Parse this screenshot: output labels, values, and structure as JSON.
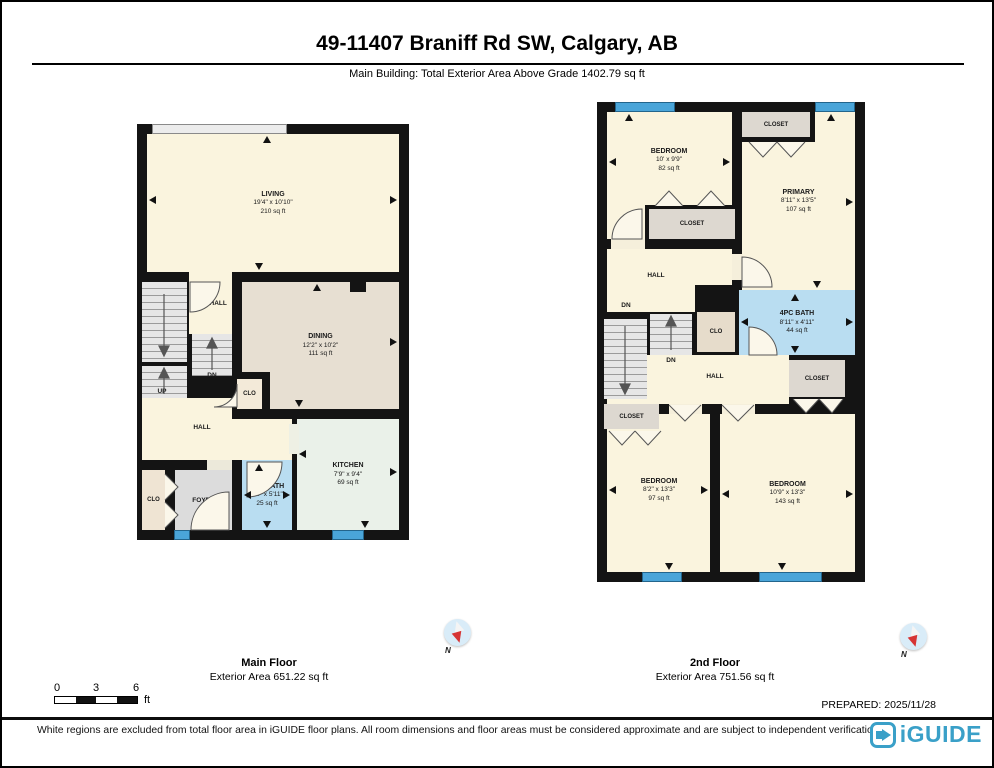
{
  "header": {
    "title": "49-11407 Braniff Rd SW, Calgary, AB",
    "subtitle": "Main Building: Total Exterior Area Above Grade 1402.79 sq ft"
  },
  "main_floor": {
    "label": "Main Floor",
    "area_label": "Exterior Area 651.22 sq ft",
    "rooms": {
      "living": {
        "name": "LIVING",
        "dims": "19'4\" x 10'10\"",
        "area": "210 sq ft"
      },
      "dining": {
        "name": "DINING",
        "dims": "12'2\" x 10'2\"",
        "area": "111 sq ft"
      },
      "kitchen": {
        "name": "KITCHEN",
        "dims": "7'9\" x 9'4\"",
        "area": "69 sq ft"
      },
      "bath": {
        "name": "2PC BATH",
        "dims": "4'4\" x 5'11\"",
        "area": "25 sq ft"
      },
      "foyer": "FOYER",
      "hall": "HALL",
      "clo": "CLO",
      "up": "UP",
      "dn": "DN"
    }
  },
  "second_floor": {
    "label": "2nd Floor",
    "area_label": "Exterior Area 751.56 sq ft",
    "rooms": {
      "bedroom_top": {
        "name": "BEDROOM",
        "dims": "10' x 9'9\"",
        "area": "82 sq ft"
      },
      "primary": {
        "name": "PRIMARY",
        "dims": "8'11\" x 13'5\"",
        "area": "107 sq ft"
      },
      "bath": {
        "name": "4PC BATH",
        "dims": "8'11\" x 4'11\"",
        "area": "44 sq ft"
      },
      "bedroom_left": {
        "name": "BEDROOM",
        "dims": "8'2\" x 13'3\"",
        "area": "97 sq ft"
      },
      "bedroom_right": {
        "name": "BEDROOM",
        "dims": "10'9\" x 13'3\"",
        "area": "143 sq ft"
      },
      "closet": "CLOSET",
      "clo": "CLO",
      "hall": "HALL",
      "dn": "DN"
    }
  },
  "compass": {
    "north_label": "N"
  },
  "scale_bar": {
    "t0": "0",
    "t3": "3",
    "t6": "6",
    "unit": "ft"
  },
  "prepared": "PREPARED: 2025/11/28",
  "footer": {
    "disclaimer": "White regions are excluded from total floor area in iGUIDE floor plans. All room dimensions and floor areas must be considered approximate and are subject to independent verification.",
    "logo_text": "iGUIDE"
  },
  "colors": {
    "wall_black": "#141414",
    "room_cream": "#faf4de",
    "dining_beige": "#e7dfd2",
    "kitchen_mint": "#eaf1e9",
    "bath_blue": "#b9ddf1",
    "closet_gray": "#ddd8d0",
    "clo_tan": "#efe4d3",
    "foyer_gray": "#dcdcdc",
    "window_blue": "#4aa5d9",
    "logo_blue": "#3aa0c8",
    "compass_red": "#d63434"
  }
}
